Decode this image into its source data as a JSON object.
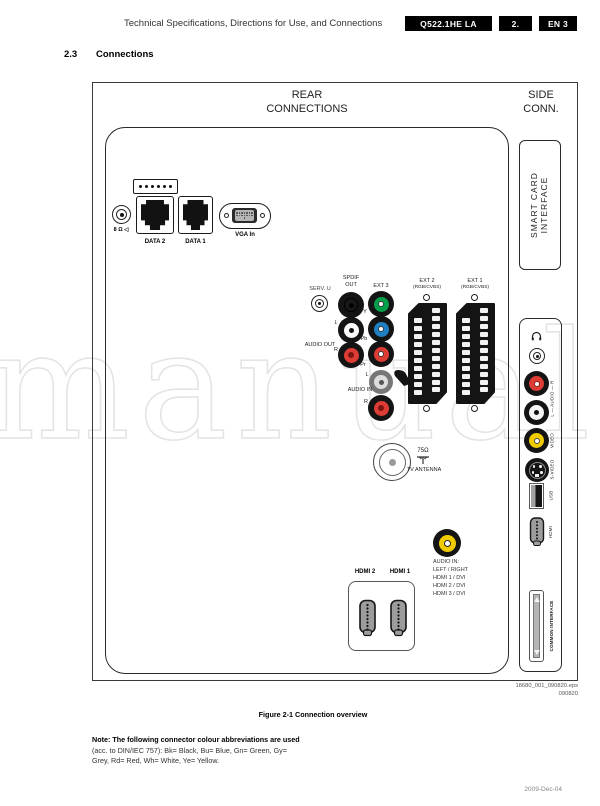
{
  "watermark": "manual",
  "header": {
    "title": "Technical Specifications, Directions for Use, and Connections",
    "chassis": "Q522.1HE LA",
    "page": "2.",
    "lang": "EN 3"
  },
  "section": {
    "number": "2.3",
    "title": "Connections"
  },
  "diagram": {
    "rear_title": [
      "REAR",
      "CONNECTIONS"
    ],
    "side_title": [
      "SIDE",
      "CONN."
    ],
    "rear": {
      "speaker_label": "8 Ω ◁",
      "data2": "DATA 2",
      "data1": "DATA 1",
      "vga": "VGA In",
      "serv": "SERV. U",
      "spdif": [
        "SPDIF",
        "OUT"
      ],
      "ext3": "EXT 3",
      "y": "Y",
      "pb": "Pb",
      "pr": "Pr",
      "l": "L",
      "r": "R",
      "audio_out": "AUDIO OUT",
      "audio_in": "AUDIO IN",
      "ext2": "EXT 2",
      "ext2_sub": "(RGB/CVBS)",
      "ext1": "EXT 1",
      "ext1_sub": "(RGB/CVBS)",
      "antenna_ohm": "75Ω",
      "antenna": "TV ANTENNA",
      "hdmi2": "HDMI 2",
      "hdmi1": "HDMI 1",
      "audio_note": [
        "AUDIO IN:",
        "LEFT / RIGHT",
        "HDMI 1 / DVI",
        "HDMI 2 / DVI",
        "HDMI 3 / DVI"
      ]
    },
    "side": {
      "smart_card": [
        "SMART CARD",
        "INTERFACE"
      ],
      "audio_lr": "L — AUDIO — R",
      "video": "VIDEO",
      "svideo": "S-VIDEO",
      "usb": "USB",
      "hdmi": "HDMI",
      "ci": "COMMON INTERFACE"
    },
    "eps": [
      "18680_001_090820.eps",
      "090820"
    ]
  },
  "caption": "Figure 2-1 Connection overview",
  "note": {
    "line1": "Note: The following connector colour abbreviations are used",
    "line2": "(acc. to DIN/IEC 757): Bk= Black, Bu= Blue, Gn= Green, Gy=",
    "line3": "Grey, Rd= Red, Wh= White, Ye= Yellow."
  },
  "footer": {
    "date": "2009-Dec-04"
  },
  "colors": {
    "green": "#00A04B",
    "blue": "#1E7FC2",
    "red": "#DC3C34",
    "yellow": "#EFCB00",
    "white": "#FFFFFF",
    "black": "#141414"
  }
}
